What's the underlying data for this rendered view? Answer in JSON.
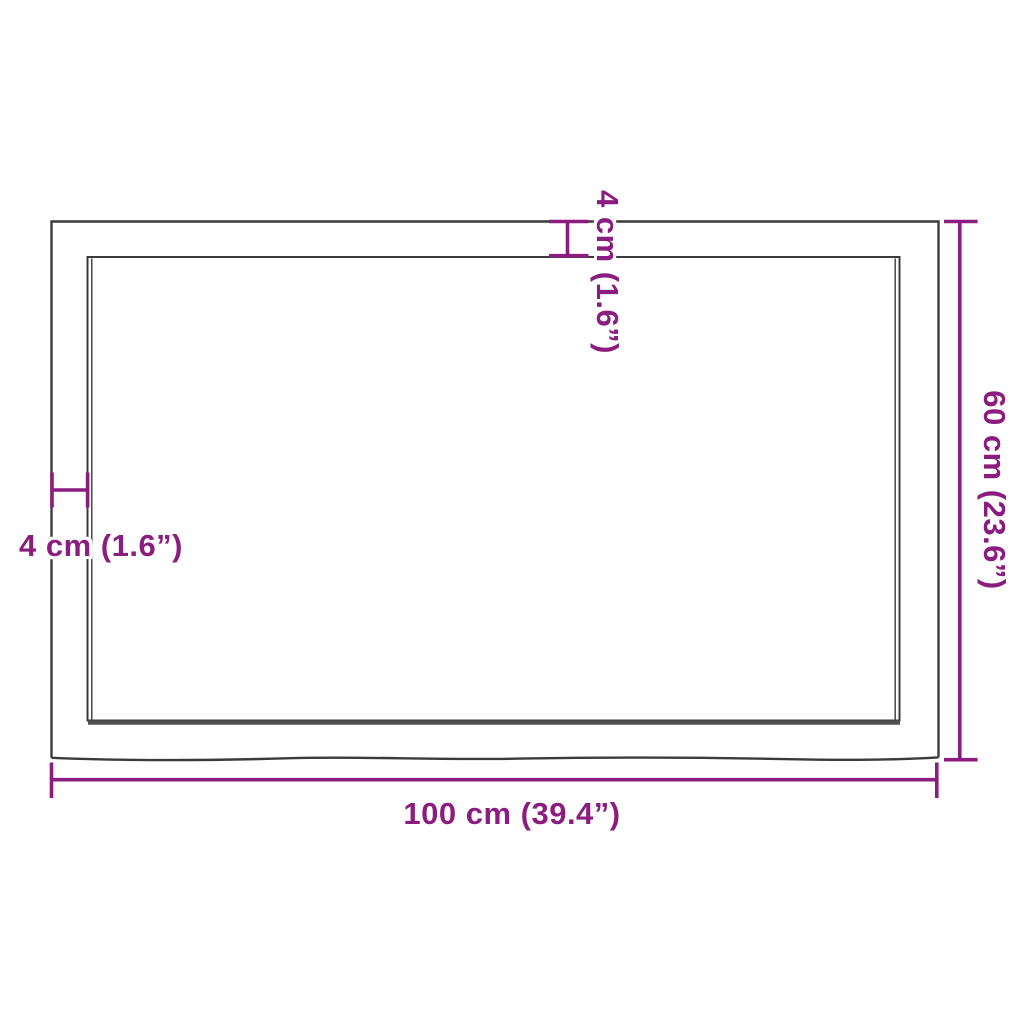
{
  "diagram": {
    "kind": "product-dimension-diagram",
    "labels": {
      "width": "100 cm (39.4”)",
      "height": "60 cm (23.6”)",
      "thickness_top": "4 cm (1.6”)",
      "thickness_left": "4 cm (1.6”)"
    },
    "values": {
      "width_cm": 100,
      "width_in": 39.4,
      "height_cm": 60,
      "height_in": 23.6,
      "thickness_cm": 4,
      "thickness_in": 1.6
    },
    "colors": {
      "accent": "#8B1C80",
      "frame": "#3B3B3B",
      "frame_shadow": "#515151",
      "background": "#FFFFFF"
    }
  }
}
